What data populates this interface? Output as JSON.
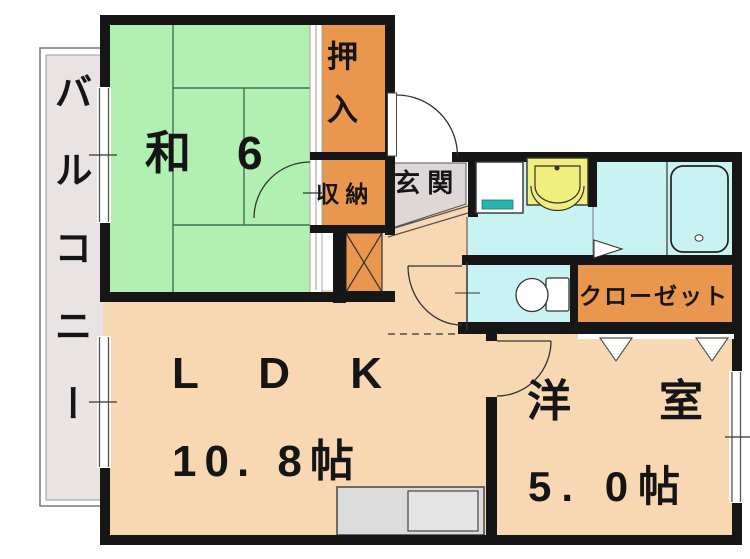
{
  "plan": {
    "balcony_label": "バルコニー",
    "washitsu_label": "和　6",
    "oshiire_label": "押入",
    "shuno_label": "収 納",
    "genkan_label": "玄 関",
    "ldk_label": "L D K",
    "ldk_size": "10. 8帖",
    "yoshitsu_label": "洋　室",
    "yoshitsu_size": "5. 0帖",
    "closet_label": "クローゼット"
  },
  "fixtures": {
    "bathtub": "bathtub",
    "toilet": "toilet",
    "washbasin": "washbasin",
    "washing_machine_pan": "washing-machine-pan",
    "kitchen_counter": "kitchen-counter",
    "pipe_space": "pipe-space-x-box"
  },
  "colors": {
    "tatami_green": "#b2efb2",
    "closet_orange": "#e9964e",
    "room_peach": "#f7d8b2",
    "wet_cyan": "#c9f3f3",
    "basin_yellow": "#f0ee7c",
    "pan_teal": "#28b4ac",
    "balcony_gray": "#e9e3e3",
    "genkan_gray": "#ddd7d7",
    "counter_gray": "#dcdcdc",
    "wall_black": "#161616",
    "tatami_line": "#41704c"
  }
}
